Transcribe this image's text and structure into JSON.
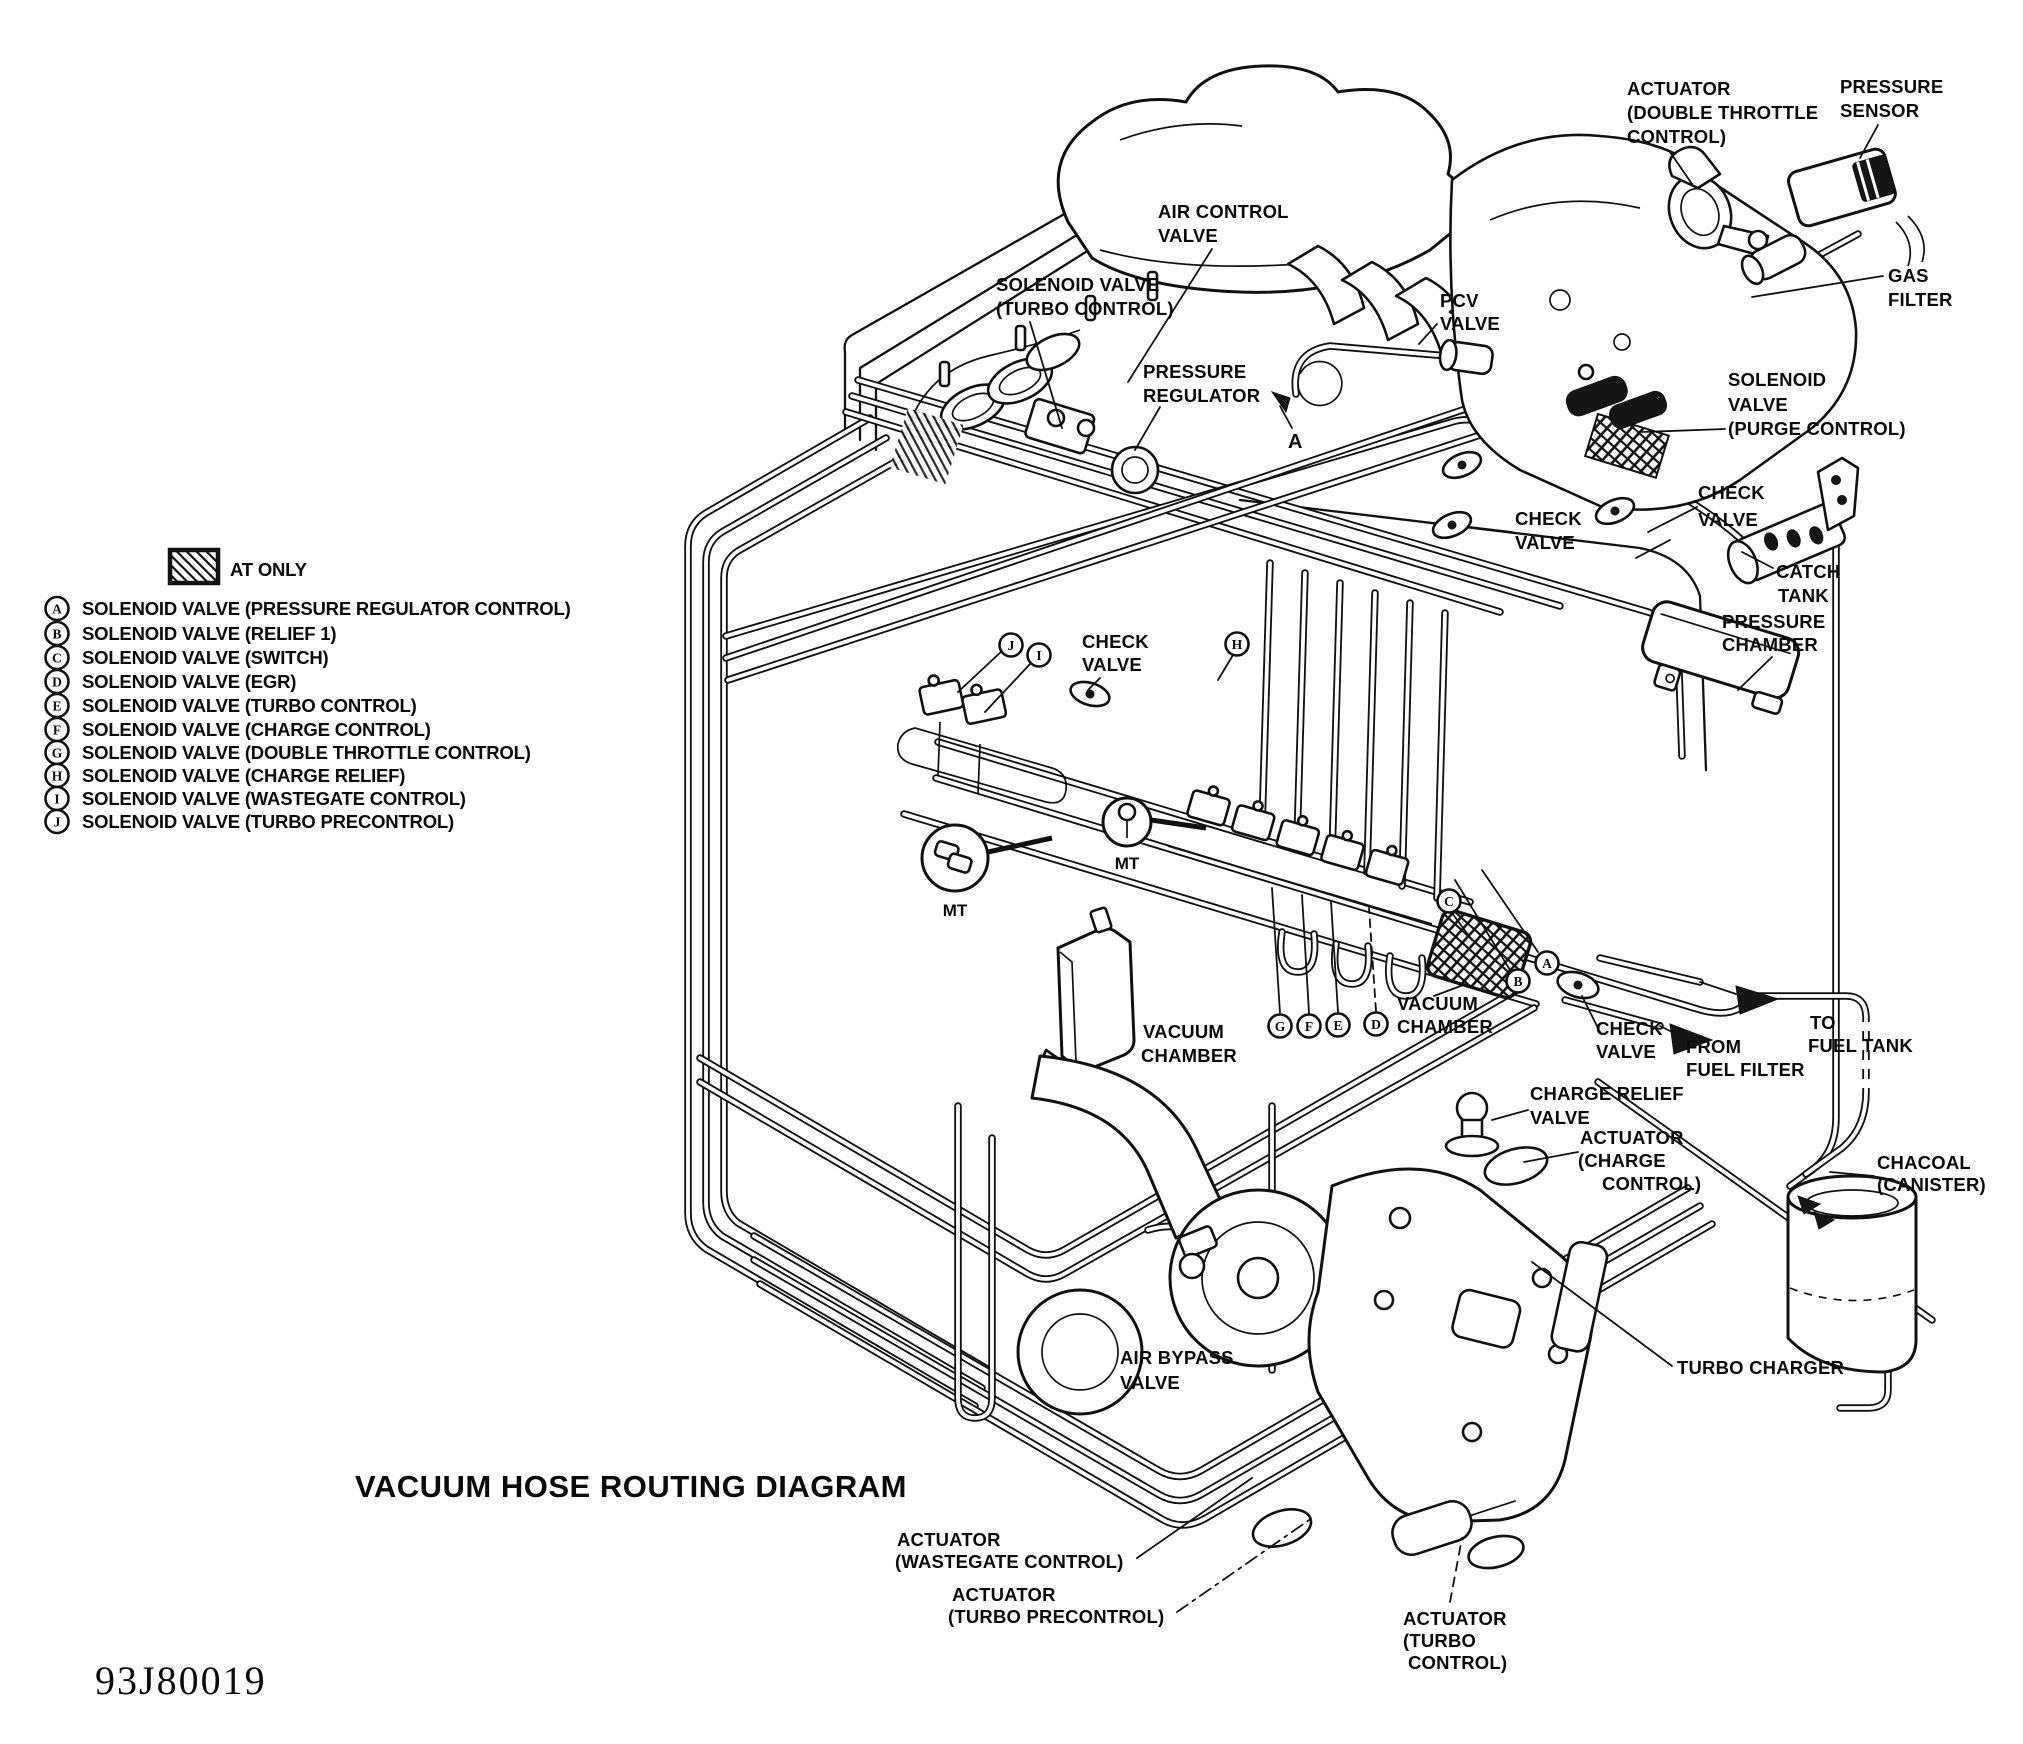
{
  "page": {
    "title": "VACUUM HOSE ROUTING DIAGRAM",
    "part_number": "93J80019"
  },
  "legend": {
    "swatch_label": "AT ONLY",
    "items": [
      {
        "letter": "A",
        "label": "SOLENOID VALVE (PRESSURE REGULATOR CONTROL)"
      },
      {
        "letter": "B",
        "label": "SOLENOID VALVE (RELIEF 1)"
      },
      {
        "letter": "C",
        "label": "SOLENOID VALVE (SWITCH)"
      },
      {
        "letter": "D",
        "label": "SOLENOID VALVE (EGR)"
      },
      {
        "letter": "E",
        "label": "SOLENOID VALVE (TURBO CONTROL)"
      },
      {
        "letter": "F",
        "label": "SOLENOID VALVE (CHARGE CONTROL)"
      },
      {
        "letter": "G",
        "label": "SOLENOID VALVE (DOUBLE THROTTLE CONTROL)"
      },
      {
        "letter": "H",
        "label": "SOLENOID VALVE (CHARGE RELIEF)"
      },
      {
        "letter": "I",
        "label": "SOLENOID VALVE (WASTEGATE CONTROL)"
      },
      {
        "letter": "J",
        "label": "SOLENOID VALVE (TURBO PRECONTROL)"
      }
    ]
  },
  "callouts": {
    "actuator_double_throttle": [
      "ACTUATOR",
      "(DOUBLE THROTTLE",
      "CONTROL)"
    ],
    "pressure_sensor": [
      "PRESSURE",
      "SENSOR"
    ],
    "gas_filter": [
      "GAS",
      "FILTER"
    ],
    "air_control_valve": [
      "AIR CONTROL",
      "VALVE"
    ],
    "solenoid_valve_turbo_control": [
      "SOLENOID VALVE",
      "(TURBO CONTROL)"
    ],
    "pressure_regulator": [
      "PRESSURE",
      "REGULATOR"
    ],
    "pcv_valve": [
      "PCV",
      "VALVE"
    ],
    "solenoid_valve_purge_control": [
      "SOLENOID",
      "VALVE",
      "(PURGE CONTROL)"
    ],
    "check_valve_upper_right": [
      "CHECK",
      "VALVE"
    ],
    "check_valve_upper_mid": [
      "CHECK",
      "VALVE"
    ],
    "catch_tank": [
      "CATCH",
      "TANK"
    ],
    "pressure_chamber": [
      "PRESSURE",
      "CHAMBER"
    ],
    "check_valve_center": [
      "CHECK",
      "VALVE"
    ],
    "vacuum_chamber_left": [
      "VACUUM",
      "CHAMBER"
    ],
    "vacuum_chamber_right": [
      "VACUUM",
      "CHAMBER"
    ],
    "check_valve_lower": [
      "CHECK",
      "VALVE"
    ],
    "from_fuel_filter": [
      "FROM",
      "FUEL FILTER"
    ],
    "to_fuel_tank": [
      "TO",
      "FUEL TANK"
    ],
    "chacoal_canister": [
      "CHACOAL",
      "(CANISTER)"
    ],
    "charge_relief_valve": [
      "CHARGE RELIEF",
      "VALVE"
    ],
    "actuator_charge_control": [
      "ACTUATOR",
      "(CHARGE",
      "CONTROL)"
    ],
    "turbo_charger": [
      "TURBO CHARGER"
    ],
    "air_bypass_valve": [
      "AIR BYPASS",
      "VALVE"
    ],
    "actuator_wastegate_control": [
      "ACTUATOR",
      "(WASTEGATE CONTROL)"
    ],
    "actuator_turbo_precontrol": [
      "ACTUATOR",
      "(TURBO PRECONTROL)"
    ],
    "actuator_turbo_control": [
      "ACTUATOR",
      "(TURBO",
      "CONTROL)"
    ]
  },
  "markers": {
    "mt": "MT",
    "point_a": "A",
    "circles": [
      "J",
      "I",
      "H",
      "G",
      "F",
      "E",
      "D",
      "C",
      "B",
      "A"
    ]
  }
}
